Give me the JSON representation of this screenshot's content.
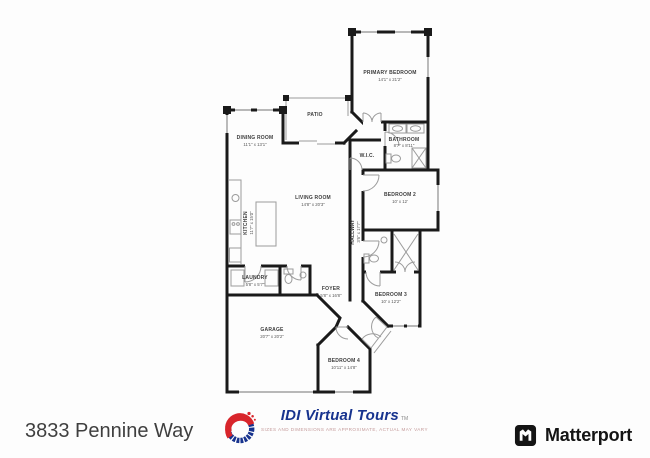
{
  "address": "3833 Pennine Way",
  "plan": {
    "rooms": [
      {
        "name": "PRIMARY BEDROOM",
        "dims": "14'1\" x 21'2\""
      },
      {
        "name": "BATHROOM",
        "dims": "8'7\" x 8'11\""
      },
      {
        "name": "W.I.C.",
        "dims": ""
      },
      {
        "name": "BEDROOM 2",
        "dims": "10' x 12'"
      },
      {
        "name": "HALLWAY",
        "dims": "3'6\" x 17'7\""
      },
      {
        "name": "BEDROOM 3",
        "dims": "10' x 12'2\""
      },
      {
        "name": "FOYER",
        "dims": "5'8\" x 16'8\""
      },
      {
        "name": "BEDROOM 4",
        "dims": "10'11\" x 14'8\""
      },
      {
        "name": "GARAGE",
        "dims": "20'7\" x 20'2\""
      },
      {
        "name": "LAUNDRY",
        "dims": "5'8\" x 5'7\""
      },
      {
        "name": "KITCHEN",
        "dims": "11'7\" x 15'0\""
      },
      {
        "name": "DINING ROOM",
        "dims": "11'1\" x 13'1\""
      },
      {
        "name": "LIVING ROOM",
        "dims": "14'8\" x 20'3\""
      },
      {
        "name": "PATIO",
        "dims": ""
      }
    ]
  },
  "footer": {
    "idi": {
      "brand": "IDI Virtual Tours",
      "tm": "TM",
      "tagline": "SIZES AND DIMENSIONS ARE APPROXIMATE, ACTUAL MAY VARY"
    },
    "matterport": {
      "brand": "Matterport"
    }
  },
  "colors": {
    "background": "#fdfdfd",
    "wall": "#1a1a1a",
    "fixture": "#9b9b9b",
    "idi_blue": "#17338e",
    "idi_red": "#d8252b",
    "matterport_black": "#141414",
    "address_text": "#3f3f3f"
  }
}
